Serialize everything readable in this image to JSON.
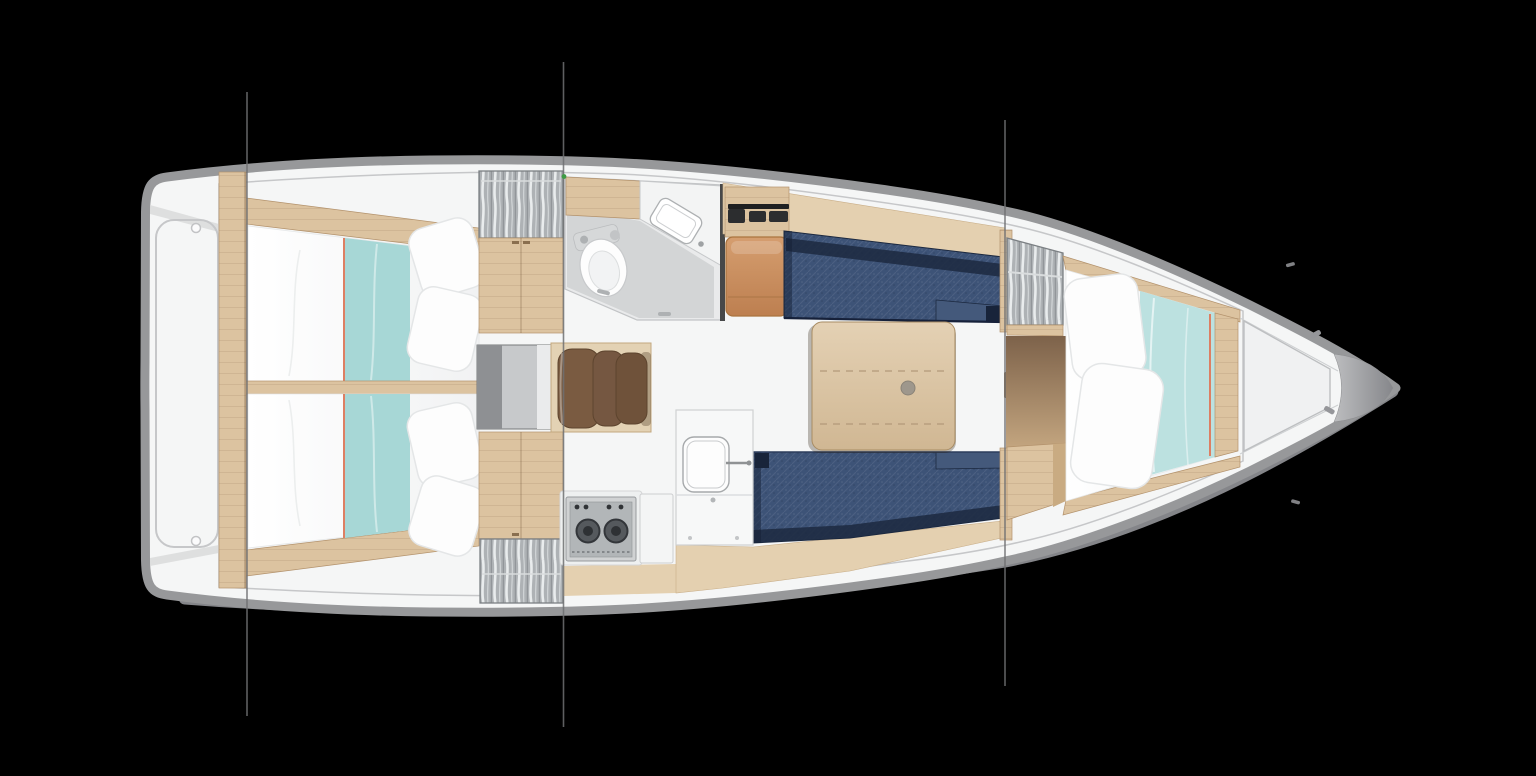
{
  "title": "Sailboat interior layout plan, top view, bow pointing right",
  "background_color": "#000000",
  "palette": {
    "bg": "#000000",
    "hull_gray": "#97989a",
    "hull_gray_dark": "#848589",
    "deck_white": "#f5f6f6",
    "deck_line": "#c6c7c9",
    "floor": "#cdb090",
    "floor_grain": "#bfa17e",
    "wood": "#dcc3a0",
    "wood_light": "#e4d0b0",
    "wood_dark": "#b3926c",
    "navy": "#3d5377",
    "navy_dark": "#1c2940",
    "teal": "#a7d7d6",
    "teal_light": "#bce1e0",
    "red_trim": "#dd7f63",
    "white_soft": "#fdfdfd",
    "pillow_line": "#e4e6e7",
    "gray_room": "#e9eaeb",
    "gray_floor": "#d3d5d6",
    "hatch_base": "#aeb2b5",
    "hatch_light": "#e9eced",
    "hatch_frame": "#7c8084",
    "steps_bg": "#e3d2b4",
    "steps_slat": "#7a5b41",
    "seat_orange": "#cb9166",
    "seat_orange_dark": "#aa743f",
    "stove_frame": "#d0d2d3",
    "stove_panel": "#b2b6b8",
    "burner": "#55595d",
    "instrument_black": "#2c2d2f",
    "engine_gray": "#c7c9cb",
    "engine_dark": "#8e9093",
    "line_gray": "#6f7072",
    "green_dot": "#3f9b45",
    "doorway_dark": "#7d624a",
    "doorway_floor": "#c3a57f"
  },
  "vessel": {
    "orientation": "bow-right",
    "section_line_x_positions": [
      247,
      563.5,
      1005
    ],
    "mast_marker_color_dot": "#3f9b45"
  },
  "areas": [
    {
      "id": "aft-deck",
      "desc": "transom platform with rounded locker lid outline and two hinge rings"
    },
    {
      "id": "aft-cabin-top",
      "desc": "aft double berth, white bedding, teal runner with red piping, two pillows"
    },
    {
      "id": "aft-cabin-bottom",
      "desc": "aft double berth, white bedding, teal runner with red piping, two pillows"
    },
    {
      "id": "hanging-lockers",
      "desc": "gray lockers with hanging clothes",
      "count": 3
    },
    {
      "id": "engine-box",
      "desc": "gray engine / companionway box between aft cabins"
    },
    {
      "id": "companionway-steps",
      "desc": "three curved wooden steps"
    },
    {
      "id": "head",
      "desc": "bathroom with toilet, vanity counter and sink, sliding door handles"
    },
    {
      "id": "nav-seat",
      "desc": "orange-brown seat with black instrument shelf above"
    },
    {
      "id": "galley",
      "desc": "two-burner stove with four knobs, fridge door, counter with sink and faucet"
    },
    {
      "id": "saloon",
      "desc": "two navy upholstered settees facing a pale wood table with center pedestal knob and two fold seams"
    },
    {
      "id": "v-berth",
      "desc": "forward double berth, two pillows, teal blanket with red piping, wood footboard"
    },
    {
      "id": "foredeck",
      "desc": "anchor locker trapezoid and gray bow fitting"
    }
  ],
  "counts": {
    "berths": 3,
    "pillows": 6,
    "settees": 2,
    "stove_burners": 2,
    "stove_knobs": 4,
    "steps": 3,
    "hanging_lockers": 3,
    "section_lines": 3,
    "hinge_rings": 2
  }
}
